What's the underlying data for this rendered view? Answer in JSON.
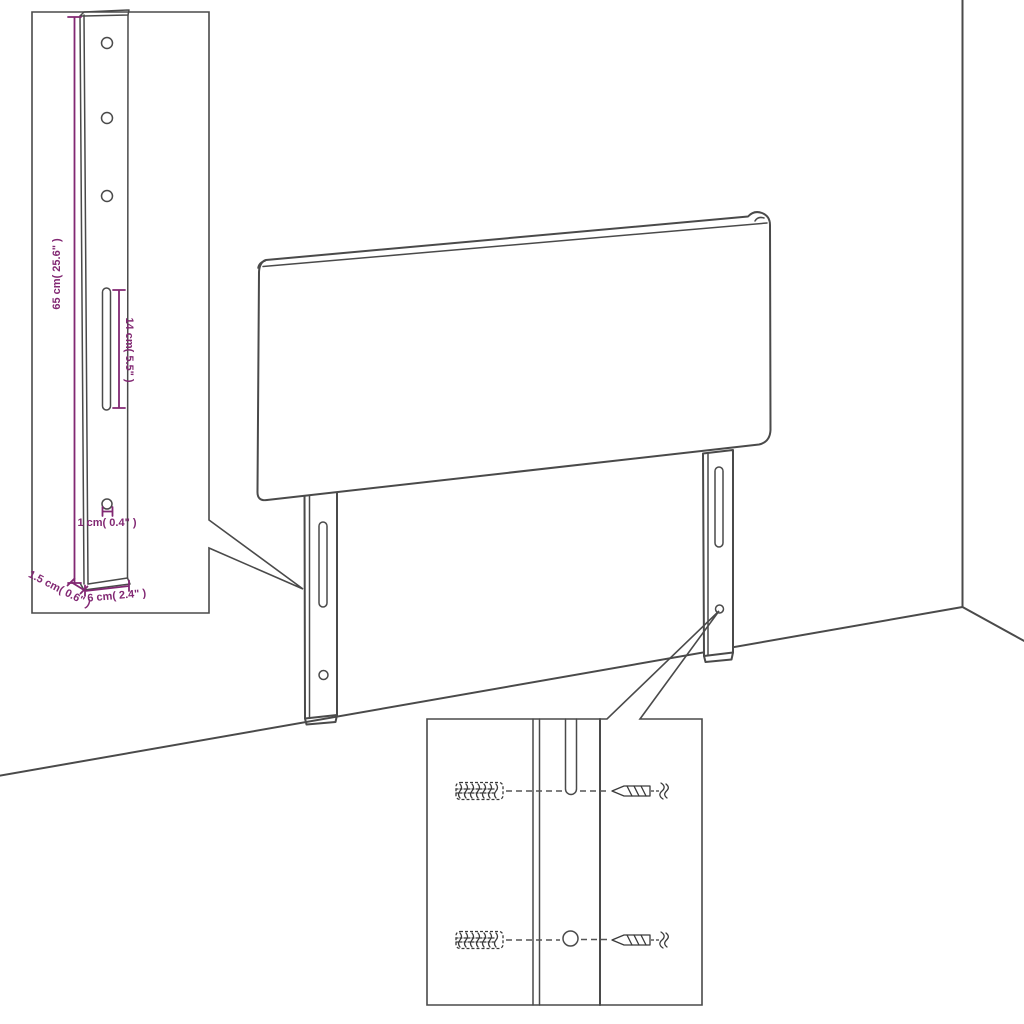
{
  "diagram": {
    "title": "Headboard mounting-leg dimension diagram",
    "labels": {
      "bracket_height": "65 cm( 25.6\" )",
      "slot_length": "14 cm( 5.5\" )",
      "hole_diameter": "1 cm( 0.4\" )",
      "bracket_thickness": "1.5 cm( 0.6\" )",
      "bracket_width": "6 cm( 2.4\" )"
    },
    "colors": {
      "line": "#4a4a4a",
      "dimension_accent": "#822873",
      "background": "#ffffff"
    }
  }
}
